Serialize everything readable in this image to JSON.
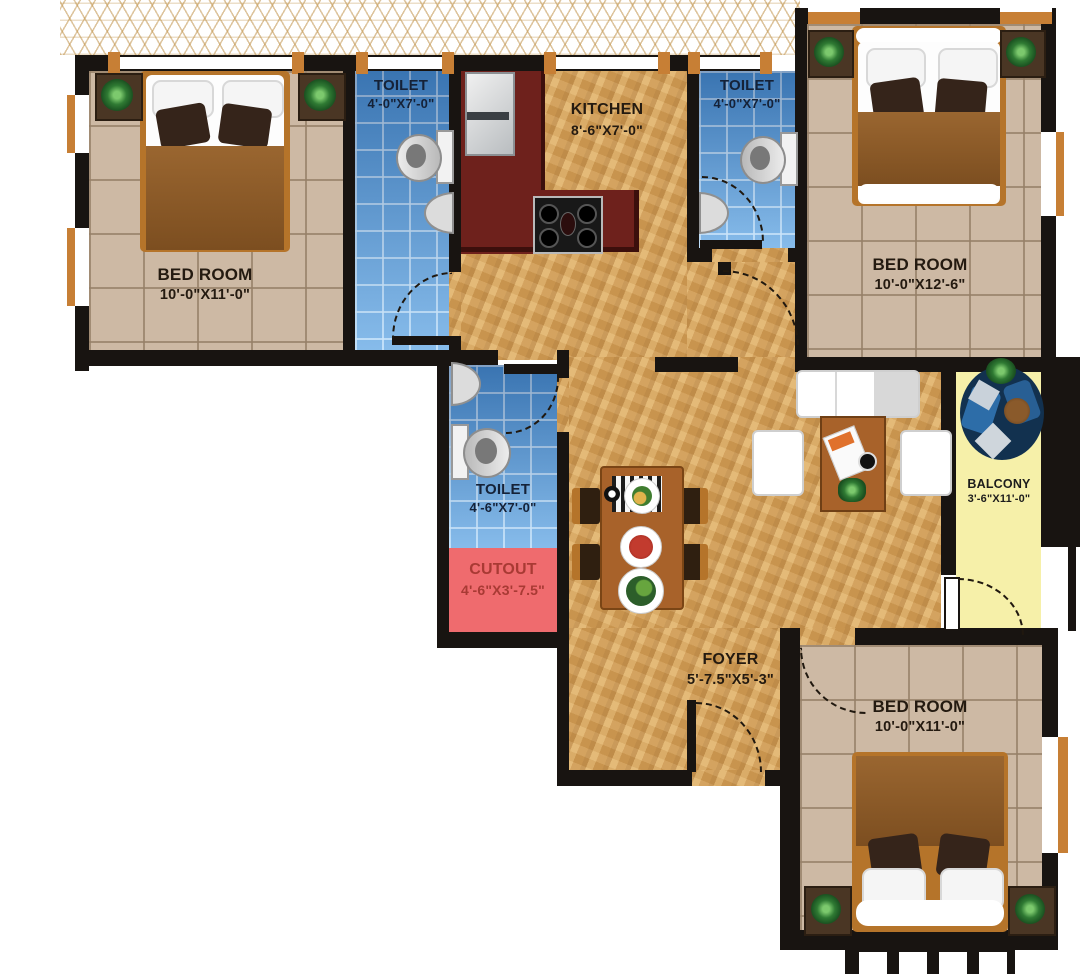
{
  "title": "2BHK-style apartment floor plan",
  "palette": {
    "wall": "#181411",
    "tile_floor": "#cdb9a4",
    "blue_tile": "#4f97d9",
    "wood_floor": "#d8a55e",
    "kitchen_counter": "#6e211c",
    "cutout_fill": "#ef6b6e",
    "balcony_fill": "#f6f0a9",
    "trim_orange": "#c77f35"
  },
  "rooms": {
    "bedroom_left": {
      "name": "BED ROOM",
      "dims": "10'-0\"X11'-0\""
    },
    "toilet_top_left": {
      "name": "TOILET",
      "dims": "4'-0\"X7'-0\""
    },
    "kitchen": {
      "name": "KITCHEN",
      "dims": "8'-6\"X7'-0\""
    },
    "toilet_top_right": {
      "name": "TOILET",
      "dims": "4'-0\"X7'-0\""
    },
    "bedroom_right": {
      "name": "BED ROOM",
      "dims": "10'-0\"X12'-6\""
    },
    "toilet_middle": {
      "name": "TOILET",
      "dims": "4'-6\"X7'-0\""
    },
    "cutout": {
      "name": "CUTOUT",
      "dims": "4'-6\"X3'-7.5\""
    },
    "balcony": {
      "name": "BALCONY",
      "dims": "3'-6\"X11'-0\""
    },
    "foyer": {
      "name": "FOYER",
      "dims": "5'-7.5\"X5'-3\""
    },
    "bedroom_bottom": {
      "name": "BED ROOM",
      "dims": "10'-0\"X11'-0\""
    }
  }
}
